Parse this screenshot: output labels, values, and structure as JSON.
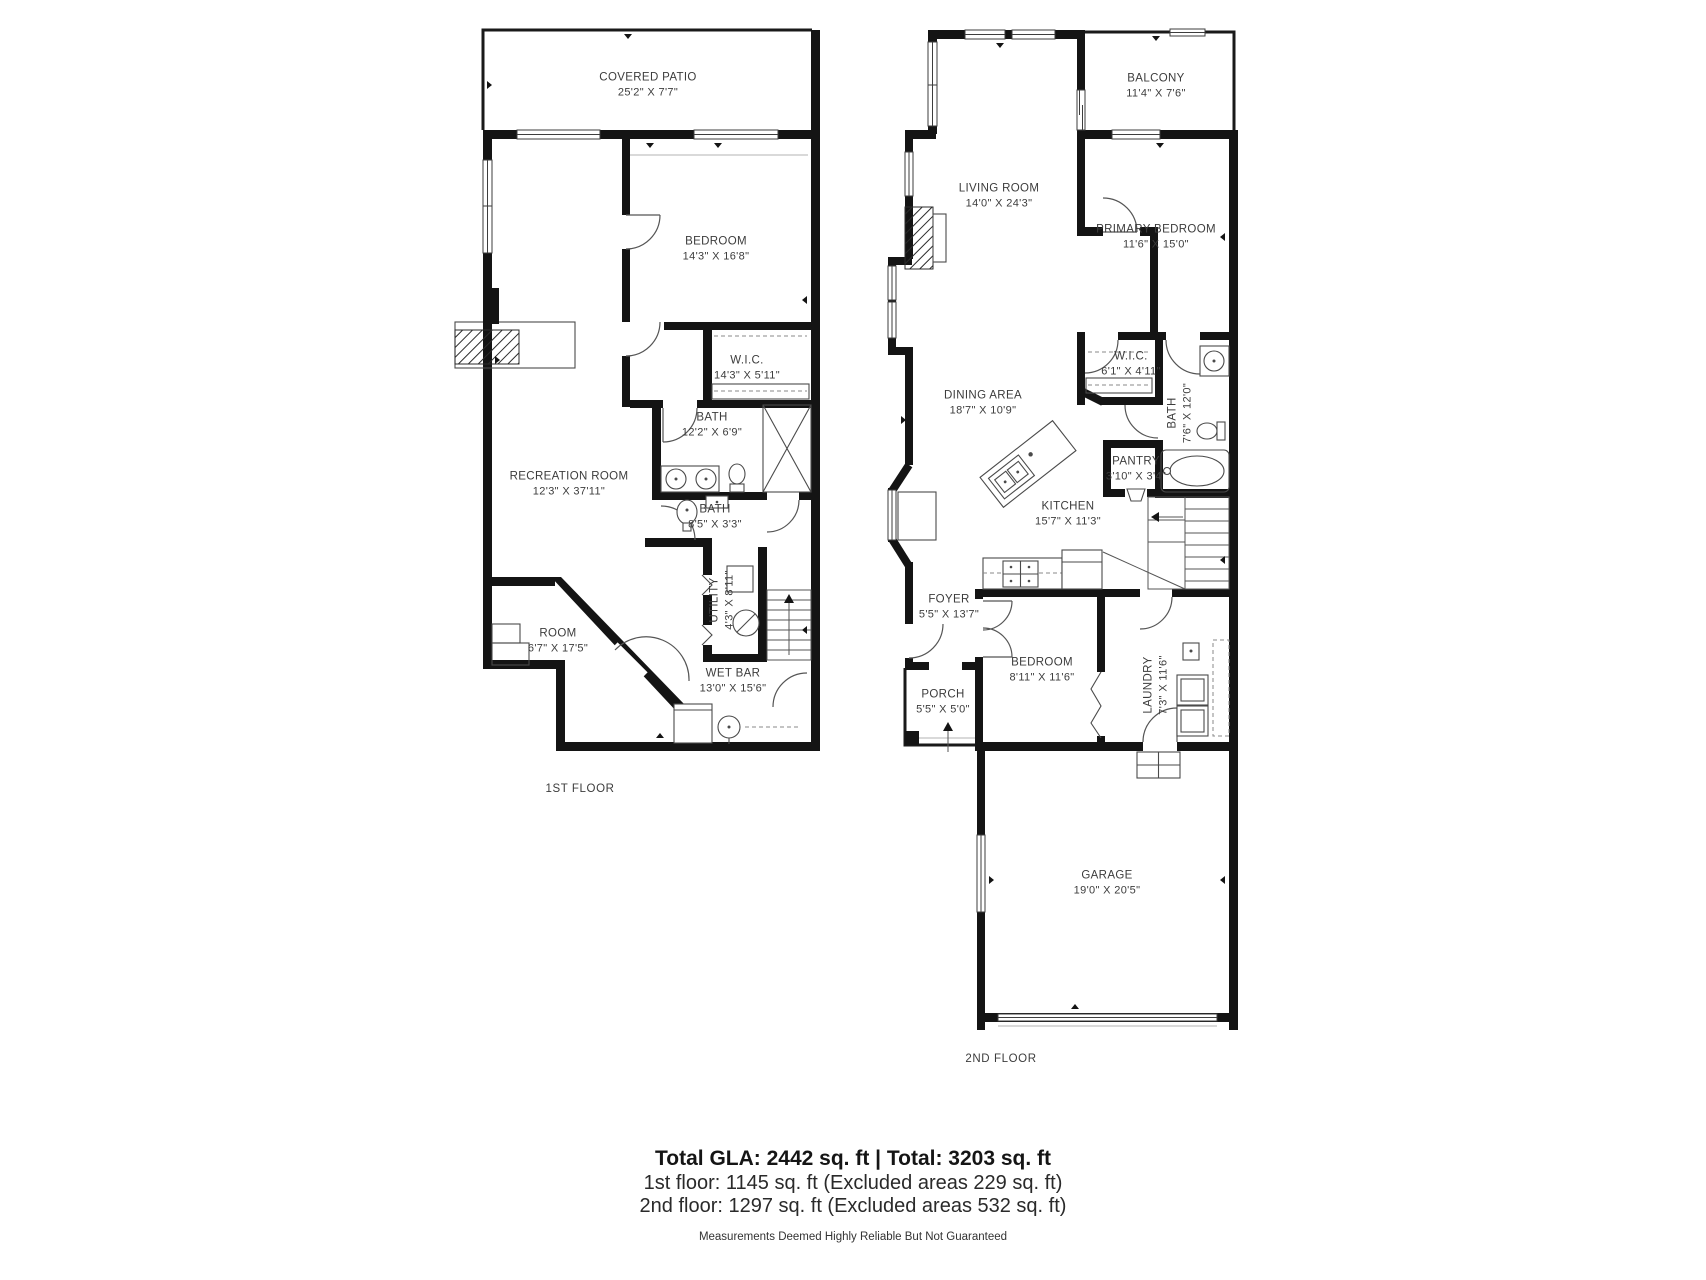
{
  "colors": {
    "wall": "#141414",
    "background": "#ffffff",
    "label_text": "#3c3c3c"
  },
  "floors": [
    {
      "id": "first",
      "label": "1ST FLOOR",
      "label_pos": {
        "x": 580,
        "y": 789
      },
      "rooms": [
        {
          "name": "COVERED PATIO",
          "dims": "25'2\" X 7'7\"",
          "x": 648,
          "y": 85
        },
        {
          "name": "BEDROOM",
          "dims": "14'3\" X 16'8\"",
          "x": 716,
          "y": 249
        },
        {
          "name": "W.I.C.",
          "dims": "14'3\" X 5'11\"",
          "x": 747,
          "y": 368
        },
        {
          "name": "BATH",
          "dims": "12'2\" X 6'9\"",
          "x": 712,
          "y": 425
        },
        {
          "name": "RECREATION ROOM",
          "dims": "12'3\" X 37'11\"",
          "x": 569,
          "y": 484
        },
        {
          "name": "BATH",
          "dims": "8'5\" X 3'3\"",
          "x": 715,
          "y": 517
        },
        {
          "name": "UTILITY",
          "dims": "4'3\" X 8'11\"",
          "x": 722,
          "y": 600,
          "rotated": true
        },
        {
          "name": "ROOM",
          "dims": "6'7\" X 17'5\"",
          "x": 558,
          "y": 641
        },
        {
          "name": "WET BAR",
          "dims": "13'0\" X 15'6\"",
          "x": 733,
          "y": 681
        }
      ]
    },
    {
      "id": "second",
      "label": "2ND FLOOR",
      "label_pos": {
        "x": 1001,
        "y": 1059
      },
      "rooms": [
        {
          "name": "BALCONY",
          "dims": "11'4\" X 7'6\"",
          "x": 1156,
          "y": 86
        },
        {
          "name": "LIVING ROOM",
          "dims": "14'0\" X 24'3\"",
          "x": 999,
          "y": 196
        },
        {
          "name": "PRIMARY BEDROOM",
          "dims": "11'6\" X 15'0\"",
          "x": 1156,
          "y": 237
        },
        {
          "name": "W.I.C.",
          "dims": "6'1\" X 4'11\"",
          "x": 1131,
          "y": 364
        },
        {
          "name": "DINING AREA",
          "dims": "18'7\" X 10'9\"",
          "x": 983,
          "y": 403
        },
        {
          "name": "BATH",
          "dims": "7'6\" X 12'0\"",
          "x": 1180,
          "y": 413,
          "rotated": true
        },
        {
          "name": "PANTRY",
          "dims": "3'10\" X 3'4\"",
          "x": 1136,
          "y": 469
        },
        {
          "name": "KITCHEN",
          "dims": "15'7\" X 11'3\"",
          "x": 1068,
          "y": 514
        },
        {
          "name": "FOYER",
          "dims": "5'5\" X 13'7\"",
          "x": 949,
          "y": 607
        },
        {
          "name": "BEDROOM",
          "dims": "8'11\" X 11'6\"",
          "x": 1042,
          "y": 670
        },
        {
          "name": "PORCH",
          "dims": "5'5\" X 5'0\"",
          "x": 943,
          "y": 702
        },
        {
          "name": "LAUNDRY",
          "dims": "7'3\" X 11'6\"",
          "x": 1156,
          "y": 685,
          "rotated": true
        },
        {
          "name": "GARAGE",
          "dims": "19'0\" X 20'5\"",
          "x": 1107,
          "y": 883
        }
      ]
    }
  ],
  "summary": {
    "total_line": "Total GLA: 2442 sq. ft | Total: 3203 sq. ft",
    "first_floor_line": "1st floor: 1145 sq. ft (Excluded areas 229 sq. ft)",
    "second_floor_line": "2nd floor: 1297 sq. ft (Excluded areas 532 sq. ft)",
    "disclaimer": "Measurements Deemed Highly Reliable But Not Guaranteed"
  }
}
